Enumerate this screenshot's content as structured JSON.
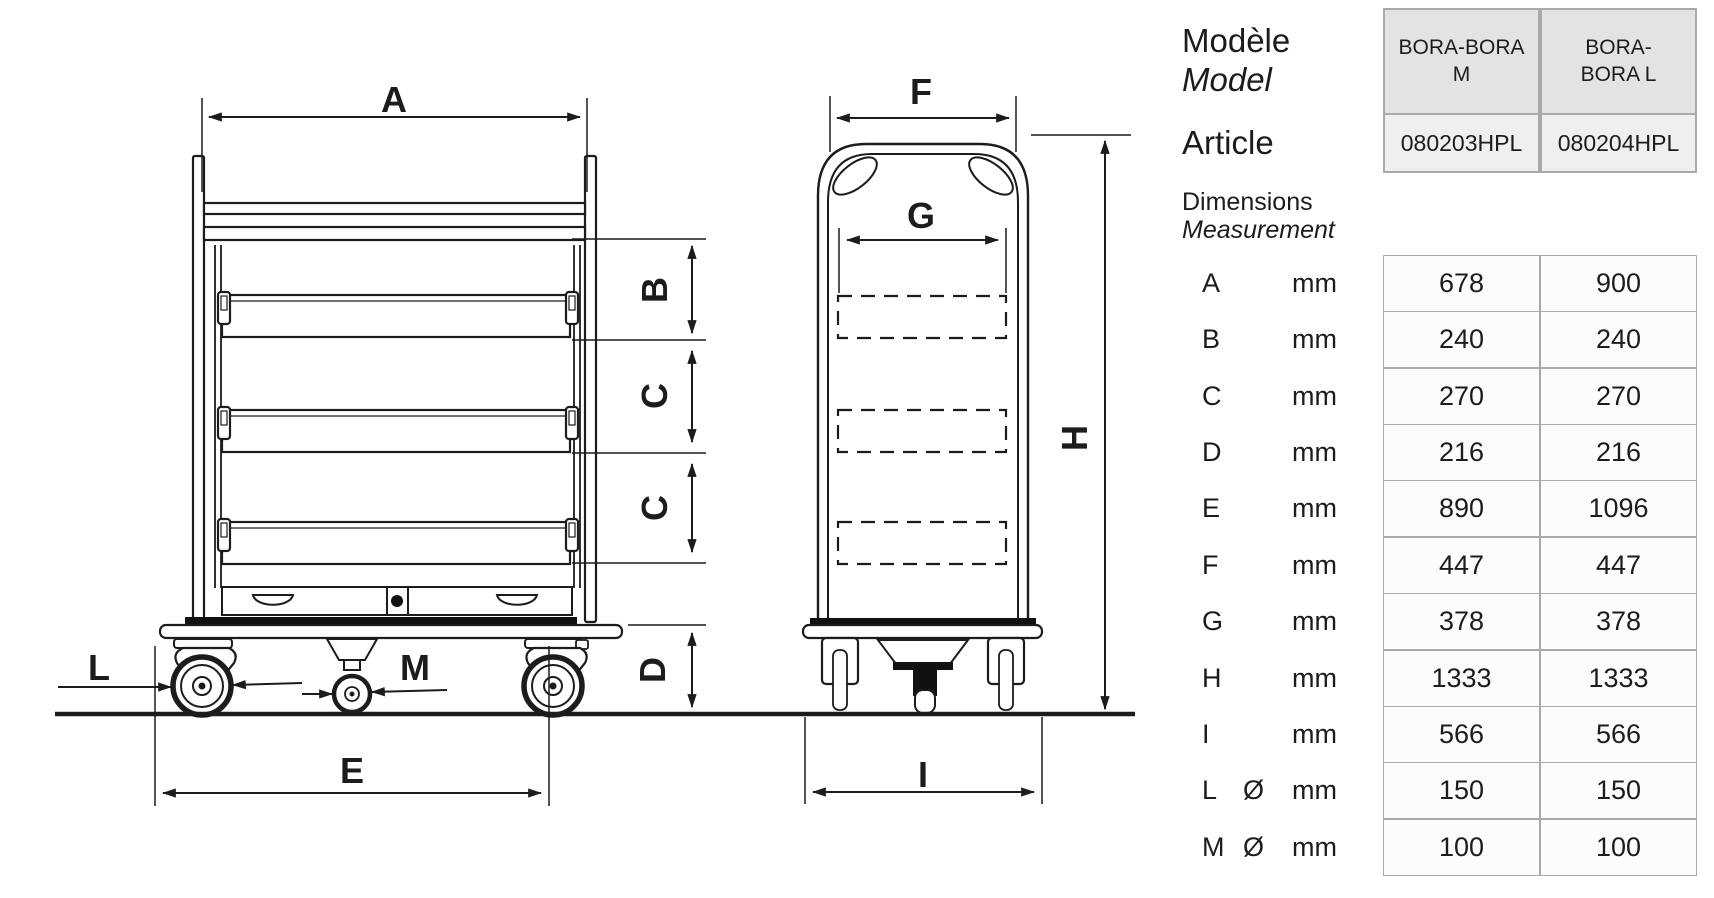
{
  "drawing": {
    "front_labels": {
      "A": "A",
      "B": "B",
      "C_upper": "C",
      "C_lower": "C",
      "D": "D",
      "E": "E",
      "L": "L",
      "M": "M"
    },
    "side_labels": {
      "F": "F",
      "G": "G",
      "H": "H",
      "I": "I"
    }
  },
  "panel": {
    "model_label": "Modèle",
    "model_label_translated": "Model",
    "article_label": "Article",
    "dimensions_label": "Dimensions",
    "dimensions_label_translated": "Measurement",
    "columns": [
      {
        "line1": "BORA-BORA",
        "line2": "M"
      },
      {
        "line1": "BORA-",
        "line2": "BORA L"
      }
    ],
    "articles": [
      "080203HPL",
      "080204HPL"
    ],
    "rows": [
      {
        "dim": "A",
        "unit_prefix": "",
        "unit": "mm",
        "bora_m": "678",
        "bora_l": "900"
      },
      {
        "dim": "B",
        "unit_prefix": "",
        "unit": "mm",
        "bora_m": "240",
        "bora_l": "240"
      },
      {
        "dim": "C",
        "unit_prefix": "",
        "unit": "mm",
        "bora_m": "270",
        "bora_l": "270"
      },
      {
        "dim": "D",
        "unit_prefix": "",
        "unit": "mm",
        "bora_m": "216",
        "bora_l": "216"
      },
      {
        "dim": "E",
        "unit_prefix": "",
        "unit": "mm",
        "bora_m": "890",
        "bora_l": "1096"
      },
      {
        "dim": "F",
        "unit_prefix": "",
        "unit": "mm",
        "bora_m": "447",
        "bora_l": "447"
      },
      {
        "dim": "G",
        "unit_prefix": "",
        "unit": "mm",
        "bora_m": "378",
        "bora_l": "378"
      },
      {
        "dim": "H",
        "unit_prefix": "",
        "unit": "mm",
        "bora_m": "1333",
        "bora_l": "1333"
      },
      {
        "dim": "I",
        "unit_prefix": "",
        "unit": "mm",
        "bora_m": "566",
        "bora_l": "566"
      },
      {
        "dim": "L",
        "unit_prefix": "Ø",
        "unit": "mm",
        "bora_m": "150",
        "bora_l": "150"
      },
      {
        "dim": "M",
        "unit_prefix": "Ø",
        "unit": "mm",
        "bora_m": "100",
        "bora_l": "100"
      }
    ]
  },
  "colors": {
    "line": "#1c1c1c",
    "table_border": "#a9a9a9",
    "header_bg": "#e3e3e3",
    "article_bg": "#efefef",
    "cell_bg": "#fcfcfc"
  }
}
